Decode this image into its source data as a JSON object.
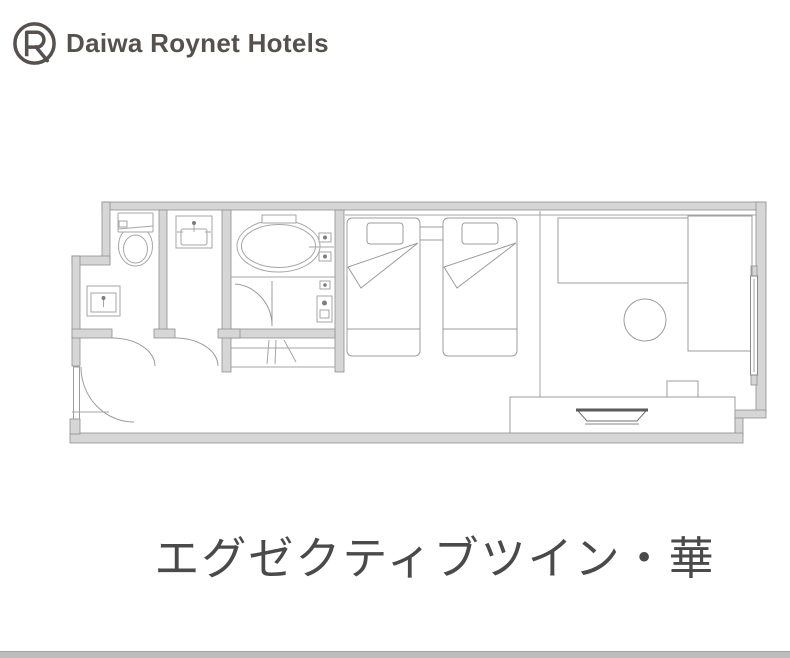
{
  "header": {
    "brand": "Daiwa Roynet Hotels"
  },
  "floorplan": {
    "caption": "エグゼクティブツイン・華",
    "fixtures": [
      "toilet",
      "powder-sink",
      "wash-basin",
      "bathtub",
      "shower-fixtures",
      "closet-hanger-rod",
      "entrance-door",
      "toilet-door",
      "washroom-door",
      "bathroom-door",
      "twin-bed-left",
      "twin-bed-right",
      "nightstand",
      "fold-back-duvet",
      "sofa-desk",
      "side-counter",
      "round-stool",
      "tv-chair",
      "tv-board",
      "tv",
      "window"
    ]
  },
  "colors": {
    "background": "#ffffff",
    "wall_fill": "#d6d6d6",
    "wall_stroke": "#8f8f8f",
    "fixture_line": "#a6a6a6",
    "furniture_line": "#9c9c9c",
    "dark_detail": "#5a5a5a",
    "brand_text": "#57514e",
    "caption_text": "#4a4a4a",
    "bottom_bar": "#bdbdbd"
  }
}
